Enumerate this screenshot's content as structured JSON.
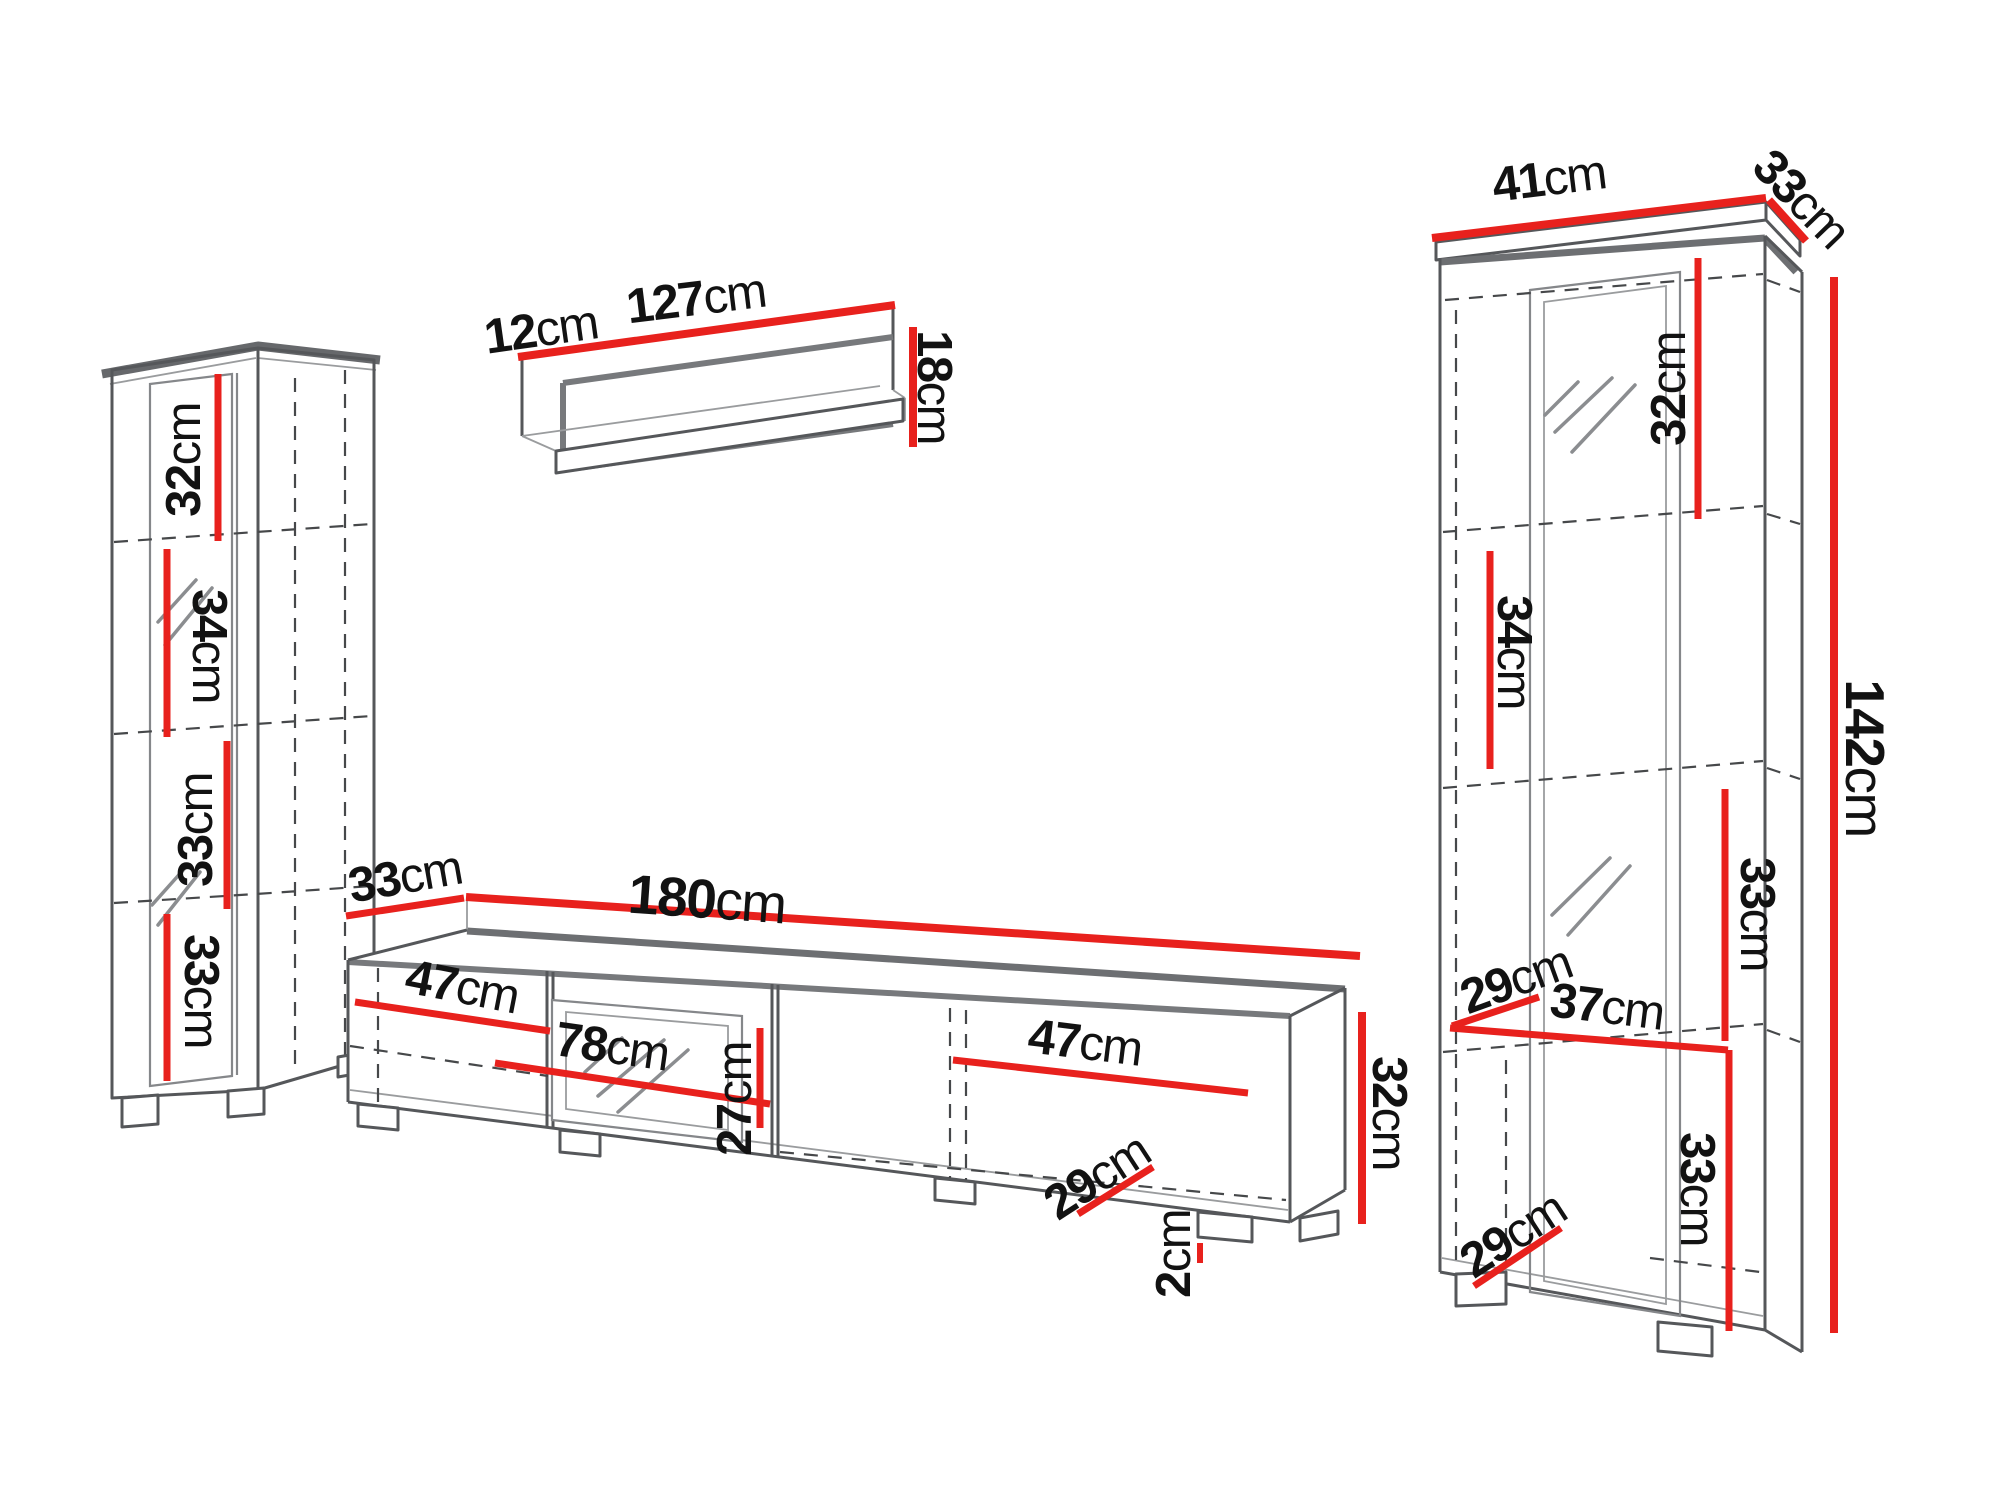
{
  "title": "Furniture wall unit set — dimension diagram",
  "colors": {
    "background": "#ffffff",
    "dimension_red": "#e8211d",
    "outline_gray": "#55575a",
    "text": "#121212"
  },
  "pieces": {
    "left_cabinet": {
      "name": "left tall cabinet",
      "sections": [
        {
          "value": "32",
          "unit": "cm"
        },
        {
          "value": "34",
          "unit": "cm"
        },
        {
          "value": "33",
          "unit": "cm"
        },
        {
          "value": "33",
          "unit": "cm"
        }
      ]
    },
    "wall_shelf": {
      "name": "wall shelf",
      "depth": {
        "value": "12",
        "unit": "cm"
      },
      "width": {
        "value": "127",
        "unit": "cm"
      },
      "height": {
        "value": "18",
        "unit": "cm"
      }
    },
    "tv_stand": {
      "name": "tv stand",
      "depth": {
        "value": "33",
        "unit": "cm"
      },
      "width": {
        "value": "180",
        "unit": "cm"
      },
      "left_section": {
        "value": "47",
        "unit": "cm"
      },
      "middle_section": {
        "value": "78",
        "unit": "cm"
      },
      "niche_height": {
        "value": "27",
        "unit": "cm"
      },
      "right_section": {
        "value": "47",
        "unit": "cm"
      },
      "height": {
        "value": "32",
        "unit": "cm"
      },
      "inner_depth": {
        "value": "29",
        "unit": "cm"
      },
      "foot_height": {
        "value": "2",
        "unit": "cm"
      }
    },
    "right_cabinet": {
      "name": "right display cabinet",
      "width": {
        "value": "41",
        "unit": "cm"
      },
      "depth": {
        "value": "33",
        "unit": "cm"
      },
      "top_section": {
        "value": "32",
        "unit": "cm"
      },
      "second_section": {
        "value": "34",
        "unit": "cm"
      },
      "height": {
        "value": "142",
        "unit": "cm"
      },
      "third_section": {
        "value": "33",
        "unit": "cm"
      },
      "shelf_depth_upper": {
        "value": "29",
        "unit": "cm"
      },
      "inner_width": {
        "value": "37",
        "unit": "cm"
      },
      "bottom_section": {
        "value": "33",
        "unit": "cm"
      },
      "shelf_depth_lower": {
        "value": "29",
        "unit": "cm"
      }
    }
  }
}
